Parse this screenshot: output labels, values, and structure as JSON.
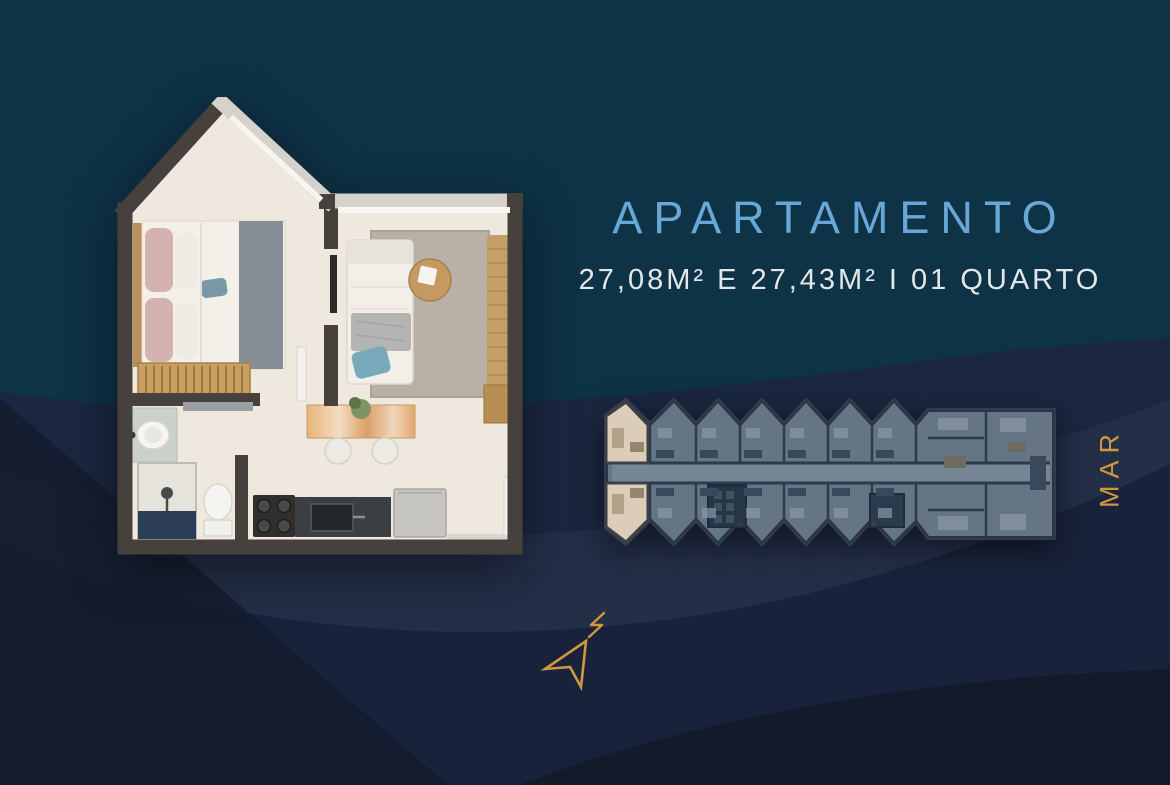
{
  "header": {
    "title": "APARTAMENTO",
    "subtitle": "27,08M² E 27,43M² I 01 QUARTO"
  },
  "side": {
    "sea_label": "MAR"
  },
  "icons": {
    "north_arrow": "north-arrow-icon",
    "apartment_plan": "apartment-floor-plan-image",
    "building_plan": "building-floor-plan-image"
  },
  "colors": {
    "background_teal": "#0e3246",
    "wave_navy": "#1b2740",
    "wave_dark": "#18223a",
    "title_blue": "#69a7d6",
    "subtitle_white": "#e4e7ea",
    "accent_gold": "#d0973f",
    "plan_wall_dark": "#46413c",
    "plan_wall_light": "#d6d2cb",
    "plan_floor": "#efe8de",
    "highlight_unit": "#dbcdb8"
  }
}
